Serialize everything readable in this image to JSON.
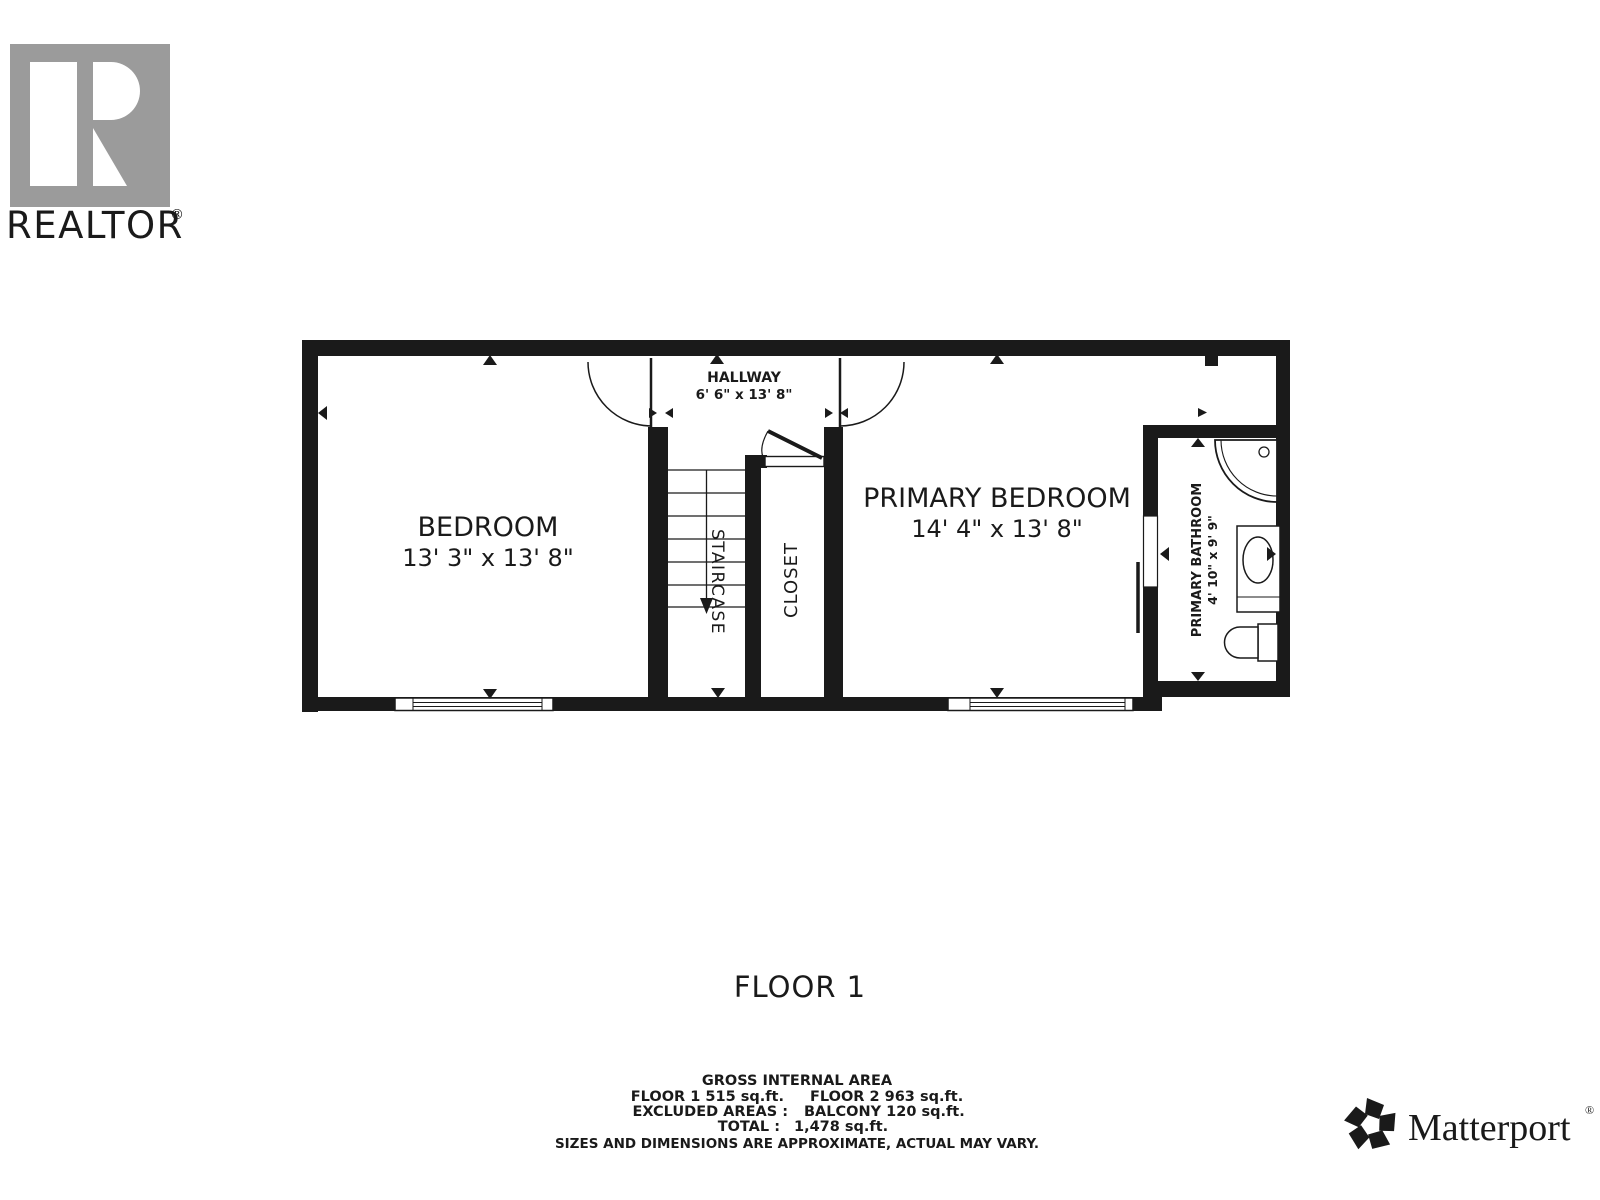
{
  "branding": {
    "realtor": {
      "text": "REALTOR",
      "reg": "®"
    },
    "matterport": {
      "text": "Matterport",
      "reg": "®"
    }
  },
  "floor_title": "FLOOR 1",
  "rooms": {
    "bedroom": {
      "name": "BEDROOM",
      "dims": "13' 3\" x 13' 8\""
    },
    "hallway": {
      "name": "HALLWAY",
      "dims": "6' 6\" x 13' 8\""
    },
    "staircase": {
      "name": "STAIRCASE"
    },
    "closet": {
      "name": "CLOSET"
    },
    "primary_bedroom": {
      "name": "PRIMARY BEDROOM",
      "dims": "14' 4\" x 13' 8\""
    },
    "primary_bathroom": {
      "name": "PRIMARY BATHROOM",
      "dims": "4' 10\" x 9' 9\""
    }
  },
  "area_summary": {
    "heading": "GROSS INTERNAL AREA",
    "floor1": "FLOOR 1 515 sq.ft.",
    "floor2": "FLOOR 2 963 sq.ft.",
    "excluded_label": "EXCLUDED AREAS :",
    "excluded_value": "BALCONY 120 sq.ft.",
    "total_label": "TOTAL :",
    "total_value": "1,478 sq.ft.",
    "disclaimer": "SIZES AND DIMENSIONS ARE APPROXIMATE, ACTUAL MAY VARY."
  },
  "colors": {
    "wall": "#1a1a1a",
    "logo_gray": "#9b9b9b",
    "disclaimer_gray": "#7d7d7d"
  }
}
